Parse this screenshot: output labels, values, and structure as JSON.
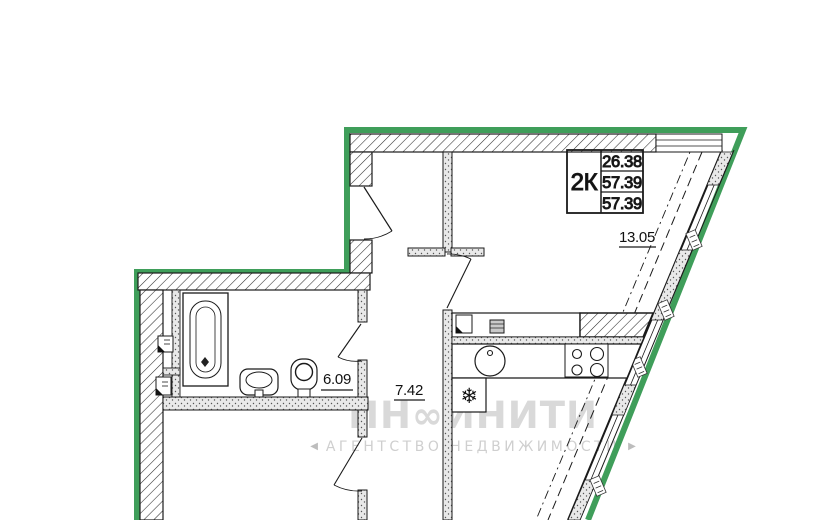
{
  "plan": {
    "unit_info": {
      "unit_type": "2К",
      "living_area": "26.38",
      "total_area": "57.39",
      "total_area_with_balcony": "57.39"
    },
    "room_areas": {
      "kitchen_living": "13.05",
      "hallway": "7.42",
      "bathroom": "6.09"
    }
  },
  "icons": {
    "fridge_snowflake": "❄"
  },
  "watermark": {
    "brand": "ИН∞ИНИТИ",
    "left_arrow": "◀",
    "tagline": "АГЕНТСТВО НЕДВИЖИМОСТИ",
    "right_arrow": "▶"
  },
  "colors": {
    "outline_green": "#3F9E5A",
    "wall_black": "#1a1a1a",
    "watermark_gray": "#d9d9d9",
    "background": "#ffffff"
  }
}
